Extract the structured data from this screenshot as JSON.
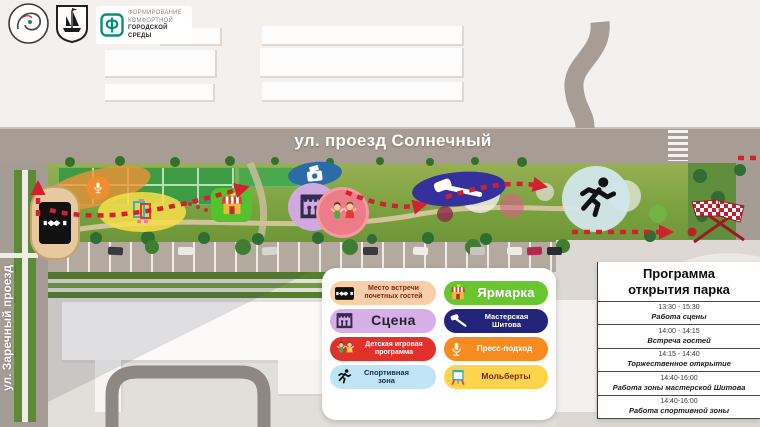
{
  "header_logos": {
    "program_logo": {
      "glyph": "Ф",
      "line1": "ФОРМИРОВАНИЕ",
      "line2": "КОМФОРТНОЙ",
      "line3": "ГОРОДСКОЙ СРЕДЫ",
      "accent_color": "#0a8f7b"
    }
  },
  "map": {
    "street_top": "ул. проезд Солнечный",
    "street_left": "ул. Заречный проезд",
    "route_color": "#d41f2f"
  },
  "legend": {
    "items": [
      {
        "label": "Место встречи почетных гостей",
        "icon": "handshake-icon",
        "bg": "#f9cfa8",
        "fg": "#8a2418"
      },
      {
        "label": "Сцена",
        "icon": "stage-icon",
        "bg": "#d8aee6",
        "fg": "#241f33"
      },
      {
        "label": "Детская игровая программа",
        "icon": "kids-icon",
        "bg": "#e0312b",
        "fg": "#ffffff"
      },
      {
        "label": "Спортивная зона",
        "icon": "runner-icon",
        "bg": "#bfe4f6",
        "fg": "#1c2b38"
      },
      {
        "label": "Ярмарка",
        "icon": "fair-icon",
        "bg": "#68c72f",
        "fg": "#ffffff"
      },
      {
        "label": "Мастерская Шитова",
        "icon": "gavel-icon",
        "bg": "#232478",
        "fg": "#ffffff"
      },
      {
        "label": "Пресс-подход",
        "icon": "mic-icon",
        "bg": "#f68b1f",
        "fg": "#ffffff"
      },
      {
        "label": "Мольберты",
        "icon": "easel-icon",
        "bg": "#fcd54d",
        "fg": "#7d1d12"
      }
    ]
  },
  "program": {
    "title_line1": "Программа",
    "title_line2": "открытия парка",
    "rows": [
      {
        "time": "13:30 - 15:30",
        "event": "Работа сцены"
      },
      {
        "time": "14:00 - 14:15",
        "event": "Встреча гостей"
      },
      {
        "time": "14:15 - 14:40",
        "event": "Торжественное открытие"
      },
      {
        "time": "14:40-16:00",
        "event": "Работа зоны мастерской Шитова"
      },
      {
        "time": "14:40-16:00",
        "event": "Работа спортивной зоны"
      }
    ]
  }
}
